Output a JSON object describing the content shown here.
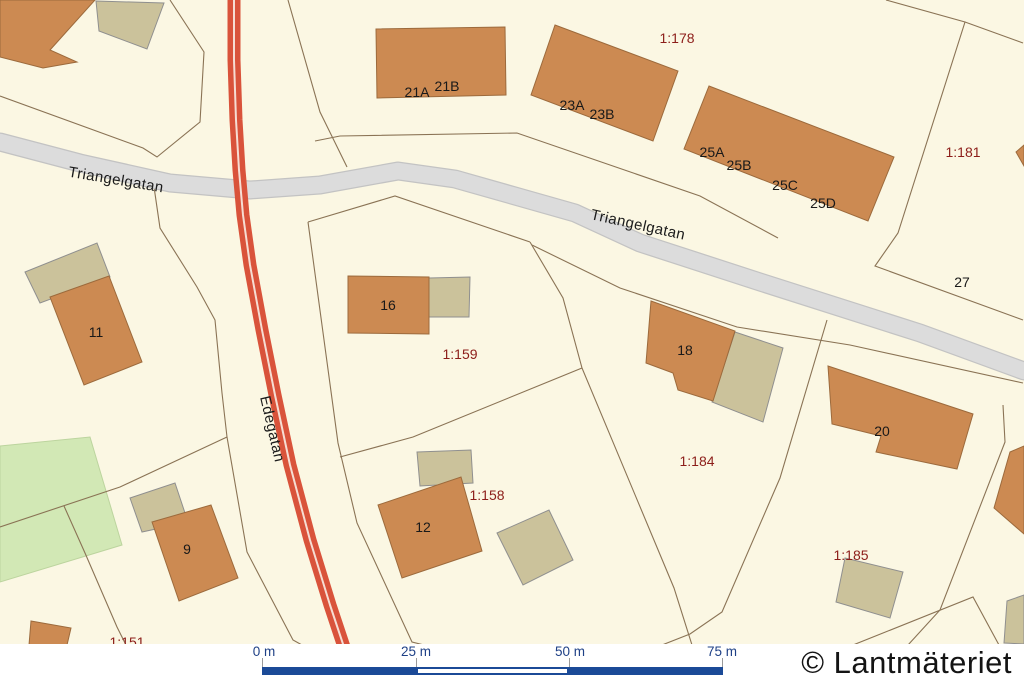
{
  "map_type": "cadastral-map",
  "streets": [
    {
      "name": "Triangelgatan"
    },
    {
      "name": "Triangelgatan"
    },
    {
      "name": "Edegatan"
    }
  ],
  "houses": [
    {
      "number": "21A"
    },
    {
      "number": "21B"
    },
    {
      "number": "23A"
    },
    {
      "number": "23B"
    },
    {
      "number": "25A"
    },
    {
      "number": "25B"
    },
    {
      "number": "25C"
    },
    {
      "number": "25D"
    },
    {
      "number": "11"
    },
    {
      "number": "16"
    },
    {
      "number": "18"
    },
    {
      "number": "20"
    },
    {
      "number": "27"
    },
    {
      "number": "9"
    },
    {
      "number": "12"
    }
  ],
  "parcels": [
    {
      "id": "1:178"
    },
    {
      "id": "1:181"
    },
    {
      "id": "1:159"
    },
    {
      "id": "1:184"
    },
    {
      "id": "1:158"
    },
    {
      "id": "1:185"
    },
    {
      "id": "1:151"
    }
  ],
  "scalebar": {
    "labels": [
      {
        "text": "0 m"
      },
      {
        "text": "25 m"
      },
      {
        "text": "50 m"
      },
      {
        "text": "75 m"
      }
    ]
  },
  "attribution": {
    "text": "© Lantmäteriet"
  },
  "colors": {
    "parcel_fill": "#fbf7e3",
    "building": "#cc8a52",
    "outbuilding": "#cbc29b",
    "green_area": "#d2e8b5",
    "road_minor": "#dcdcdc",
    "road_major": "#d9533b",
    "road_major_stripe": "#f6ddd3",
    "parcel_line": "#8a7355",
    "parcel_label": "#8c1d19",
    "house_label": "#191919",
    "scalebar_blue": "#1b4a97",
    "attribution_text": "#141414"
  }
}
